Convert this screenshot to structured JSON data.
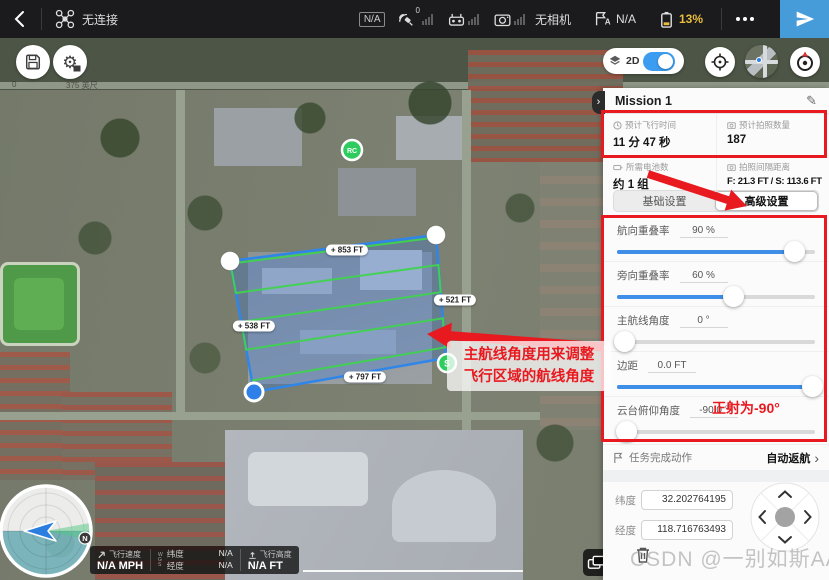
{
  "top_bar": {
    "connection_label": "无连接",
    "aircraft_status": "N/A",
    "satellite_count": "0",
    "camera_status": "无相机",
    "flight_mode_value": "N/A",
    "battery_value": "13%"
  },
  "map_controls": {
    "mode_label": "2D"
  },
  "map": {
    "labels": {
      "top": "+ 853 FT",
      "right": "+ 521 FT",
      "left": "+ 538 FT",
      "bottom": "+ 797 FT"
    },
    "markers": {
      "rc": "RC",
      "start": "S"
    },
    "scale": {
      "zero": "0",
      "distance": "375 英尺"
    }
  },
  "panel": {
    "title": "Mission 1",
    "stats": [
      {
        "label": "预计飞行时间",
        "value": "11 分 47 秒"
      },
      {
        "label": "预计拍照数量",
        "value": "187"
      },
      {
        "label": "所需电池数",
        "value": "约 1 组"
      },
      {
        "label": "拍照间隔距离",
        "value": "F: 21.3 FT / S: 113.6 FT"
      }
    ],
    "tabs": [
      {
        "label": "基础设置"
      },
      {
        "label": "高级设置"
      }
    ],
    "settings": [
      {
        "label": "航向重叠率",
        "value": "90 %",
        "fill": 90
      },
      {
        "label": "旁向重叠率",
        "value": "60 %",
        "fill": 59
      },
      {
        "label": "主航线角度",
        "value": "0 °",
        "fill": 4
      },
      {
        "label": "边距",
        "value": "0.0 FT",
        "fill": 99
      },
      {
        "label": "云台俯仰角度",
        "value": "-90.0 °",
        "fill": 5
      }
    ],
    "finish": {
      "label": "任务完成动作",
      "value": "自动返航"
    },
    "coords": {
      "lat": {
        "label": "纬度",
        "value": "32.202764195"
      },
      "lng": {
        "label": "经度",
        "value": "118.716763493"
      }
    }
  },
  "telemetry": {
    "speed": {
      "label": "飞行速度",
      "value": "N/A MPH"
    },
    "gps": "WGS",
    "lat": {
      "label": "纬度",
      "value": "N/A"
    },
    "lng": {
      "label": "经度",
      "value": "N/A"
    },
    "alt": {
      "label": "飞行高度",
      "value": "N/A FT"
    }
  },
  "annotations": {
    "note_line1": "主航线角度用来调整",
    "note_line2": "飞行区域的航线角度",
    "gimbal_note": "正射为-90°"
  },
  "watermark": {
    "text": "CSDN @一别如斯AA"
  }
}
